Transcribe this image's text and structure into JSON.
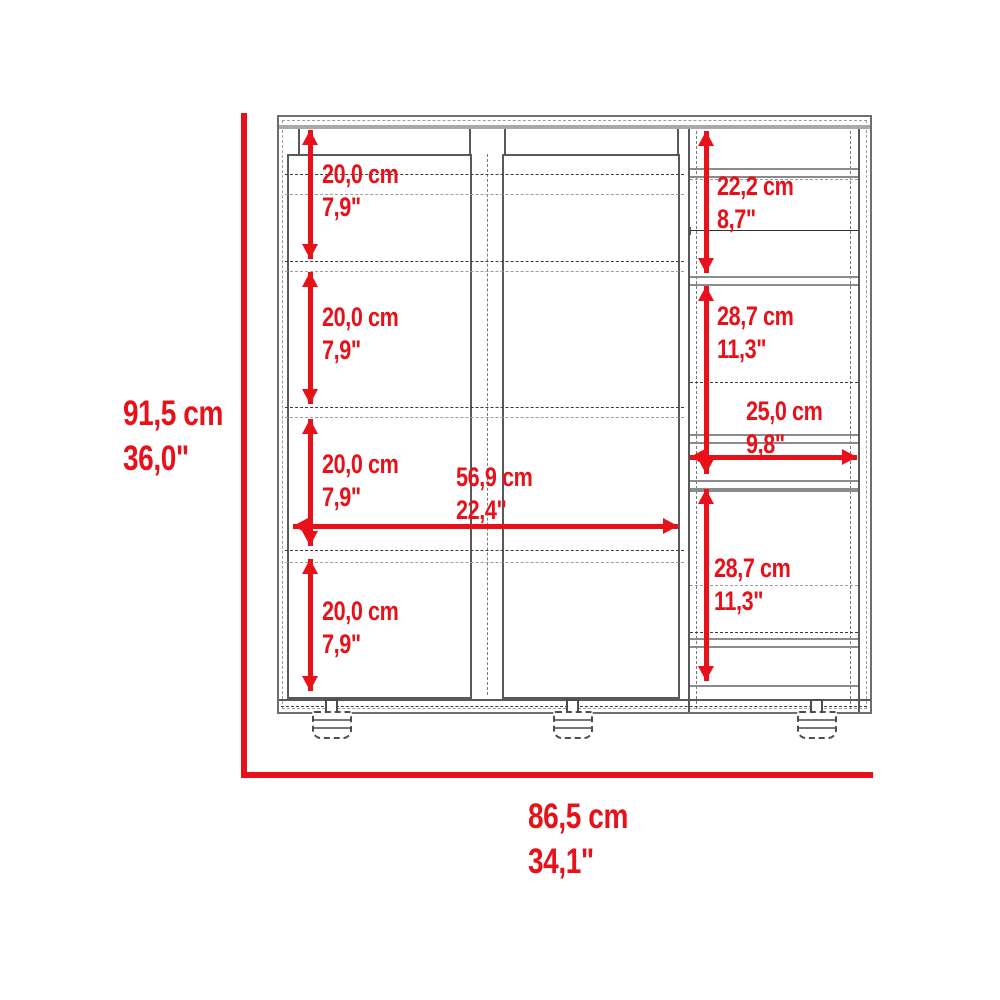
{
  "dims": {
    "overall_height": {
      "cm": "91,5 cm",
      "inch": "36,0\""
    },
    "overall_width": {
      "cm": "86,5 cm",
      "inch": "34,1\""
    },
    "left_sections": [
      {
        "cm": "20,0 cm",
        "inch": "7,9\""
      },
      {
        "cm": "20,0 cm",
        "inch": "7,9\""
      },
      {
        "cm": "20,0 cm",
        "inch": "7,9\""
      },
      {
        "cm": "20,0 cm",
        "inch": "7,9\""
      }
    ],
    "interior_width": {
      "cm": "56,9 cm",
      "inch": "22,4\""
    },
    "right_sections": [
      {
        "cm": "22,2 cm",
        "inch": "8,7\""
      },
      {
        "cm": "28,7 cm",
        "inch": "11,3\""
      },
      {
        "cm": "25,0 cm",
        "inch": "9,8\""
      },
      {
        "cm": "28,7 cm",
        "inch": "11,3\""
      }
    ],
    "colors": {
      "dimension_red": "#e8111a",
      "cabinet_line_gray": "#58595b",
      "cabinet_light_gray": "#a7a9ac"
    }
  }
}
